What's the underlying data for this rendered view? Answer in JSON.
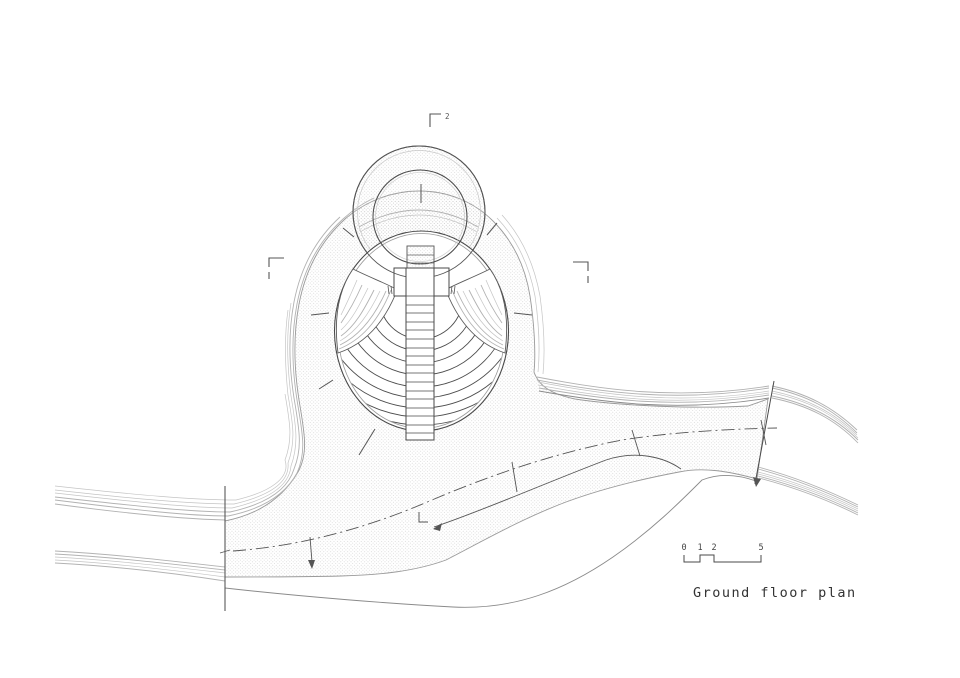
{
  "sheet": {
    "title": "Ground floor plan",
    "scale_bar": {
      "ticks": [
        "0",
        "1",
        "2",
        "5"
      ]
    },
    "section_markers": {
      "top_label": "2"
    }
  },
  "drawing_parts": {
    "plaza": "stippled-plaza-surface",
    "ring": "circular-pavilion-ring",
    "oval": "amphitheater-oval",
    "stair": "central-stair-run",
    "paths": "curved-walkway-bands",
    "centerline": "path-centerline-dashdot"
  },
  "colors": {
    "background": "#ffffff",
    "line_dark": "#4a4a4a",
    "line_mid": "#8a8a8a",
    "line_light": "#b2b2b2",
    "stipple_dot": "#c6c6c6"
  }
}
